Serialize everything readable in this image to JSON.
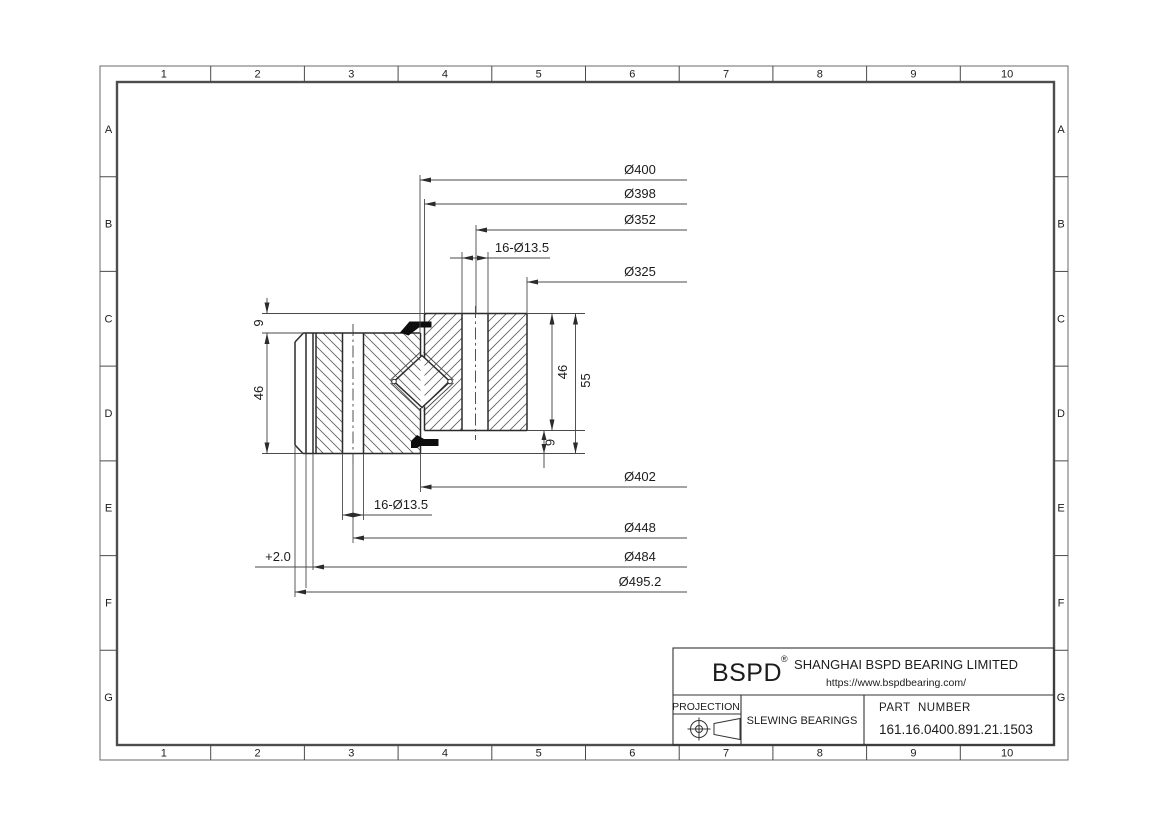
{
  "sheet": {
    "cols": [
      "1",
      "2",
      "3",
      "4",
      "5",
      "6",
      "7",
      "8",
      "9",
      "10"
    ],
    "rows": [
      "A",
      "B",
      "C",
      "D",
      "E",
      "F",
      "G"
    ]
  },
  "dims": {
    "top": [
      {
        "label": "Ø400"
      },
      {
        "label": "Ø398"
      },
      {
        "label": "Ø352"
      },
      {
        "label": "16-Ø13.5"
      },
      {
        "label": "Ø325"
      }
    ],
    "bottom": [
      {
        "label": "Ø402"
      },
      {
        "label": "16-Ø13.5"
      },
      {
        "label": "Ø448"
      },
      {
        "label": "Ø484"
      },
      {
        "label": "Ø495.2"
      }
    ],
    "gear_allowance": "+2.0",
    "left": [
      {
        "label": "9"
      },
      {
        "label": "46"
      }
    ],
    "right": [
      {
        "label": "46"
      },
      {
        "label": "55"
      },
      {
        "label": "9"
      }
    ]
  },
  "title_block": {
    "brand": "BSPD",
    "brand_mark": "®",
    "company": "SHANGHAI BSPD BEARING LIMITED",
    "website": "https://www.bspdbearing.com/",
    "projection_label": "PROJECTION",
    "product_type": "SLEWING BEARINGS",
    "part_number_label": "PART  NUMBER",
    "part_number": "161.16.0400.891.21.1503"
  },
  "colors": {
    "ink": "#2b2b2b",
    "dim_line": "#4a4a4a",
    "paper": "#ffffff"
  }
}
